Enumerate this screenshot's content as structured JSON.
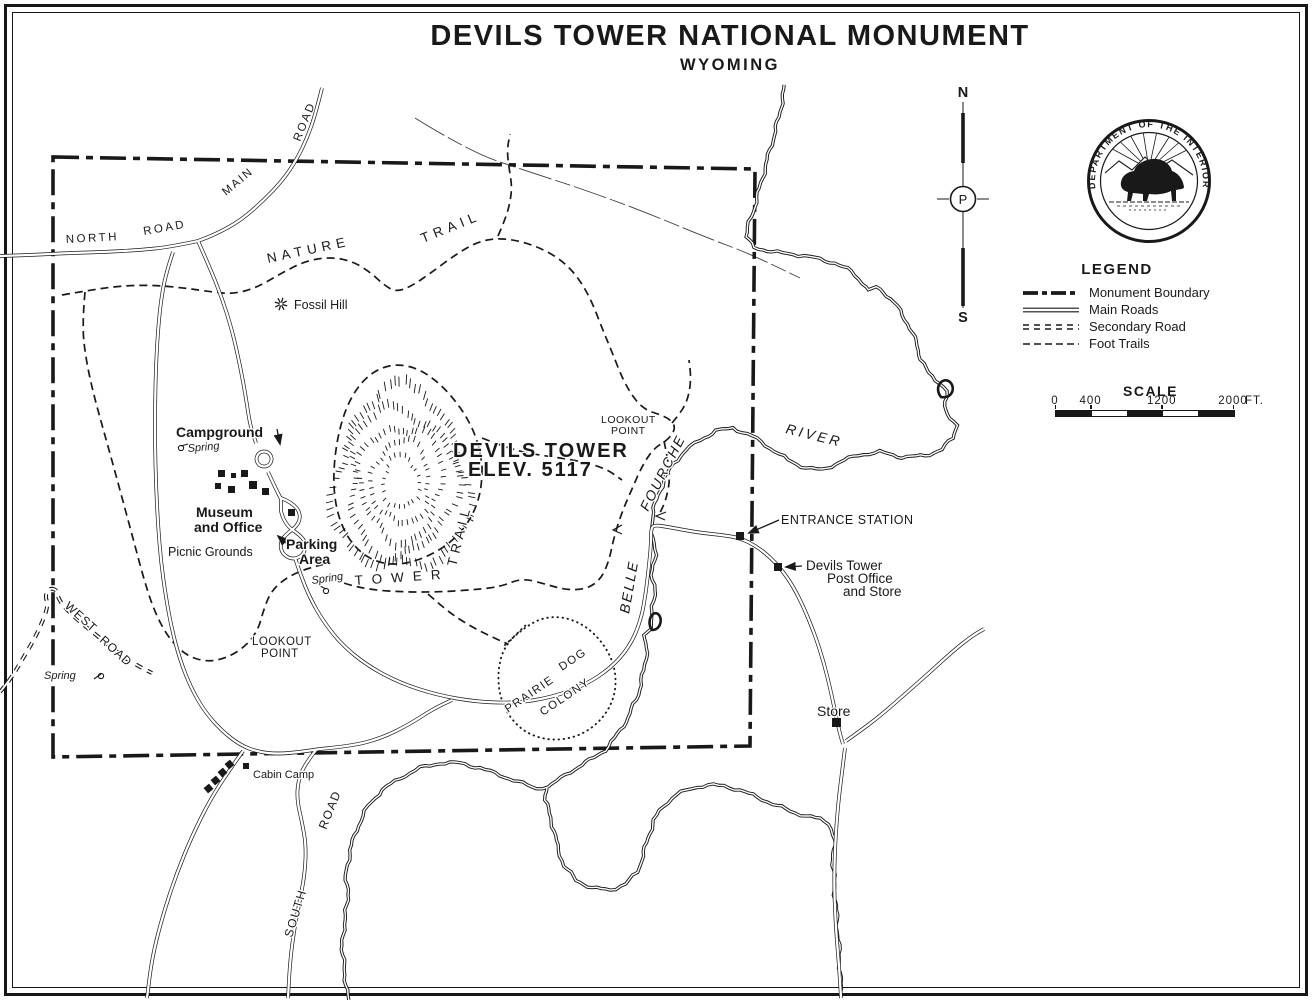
{
  "title": {
    "line1": "DEVILS TOWER NATIONAL MONUMENT",
    "line2": "WYOMING"
  },
  "legend": {
    "heading": "LEGEND",
    "items": [
      {
        "symbol": "monument-boundary-symbol",
        "label": "Monument Boundary"
      },
      {
        "symbol": "main-roads-symbol",
        "label": "Main Roads"
      },
      {
        "symbol": "secondary-road-symbol",
        "label": "Secondary Road"
      },
      {
        "symbol": "foot-trails-symbol",
        "label": "Foot Trails"
      }
    ]
  },
  "scale": {
    "heading": "SCALE",
    "ticks": [
      "0",
      "400",
      "1200",
      "2000"
    ],
    "unit": "FT.",
    "tick_offsets": [
      0,
      35.6,
      106.8,
      178
    ]
  },
  "compass": {
    "north": "N",
    "south": "S",
    "center": "P"
  },
  "seal": {
    "text": "DEPARTMENT OF THE INTERIOR"
  },
  "map": {
    "colors": {
      "ink": "#191919",
      "paper": "#ffffff"
    },
    "labels": [
      {
        "text": "NORTH",
        "x": 66,
        "y": 243,
        "size": 11.5,
        "ls": 2.5,
        "rot": -3
      },
      {
        "text": "ROAD",
        "x": 144,
        "y": 235,
        "size": 11.5,
        "ls": 2.5,
        "rot": -10
      },
      {
        "text": "MAIN",
        "x": 226,
        "y": 196,
        "size": 11.5,
        "ls": 2,
        "rot": -40
      },
      {
        "text": "ROAD",
        "x": 300,
        "y": 142,
        "size": 11.5,
        "ls": 2,
        "rot": -68
      },
      {
        "text": "NATURE",
        "x": 268,
        "y": 263,
        "size": 13.5,
        "ls": 5,
        "rot": -12
      },
      {
        "text": "TRAIL",
        "x": 423,
        "y": 243,
        "size": 13.5,
        "ls": 5,
        "rot": -22
      },
      {
        "text": "Fossil Hill",
        "x": 294,
        "y": 309,
        "size": 12.5
      },
      {
        "text": "Campground",
        "x": 176,
        "y": 437,
        "size": 14,
        "bold": true
      },
      {
        "text": "Spring",
        "x": 188,
        "y": 452,
        "size": 11,
        "italic": true,
        "rot": -5
      },
      {
        "text": "Museum",
        "x": 196,
        "y": 517,
        "size": 14,
        "bold": true
      },
      {
        "text": "and Office",
        "x": 194,
        "y": 532,
        "size": 14,
        "bold": true
      },
      {
        "text": "Picnic Grounds",
        "x": 168,
        "y": 556,
        "size": 12.5
      },
      {
        "text": "Parking",
        "x": 286,
        "y": 549,
        "size": 14,
        "bold": true
      },
      {
        "text": "Area",
        "x": 299,
        "y": 564,
        "size": 14,
        "bold": true
      },
      {
        "text": "Spring",
        "x": 312,
        "y": 584,
        "size": 11,
        "italic": true,
        "rot": -8
      },
      {
        "text": "DEVILS TOWER",
        "x": 453,
        "y": 457,
        "size": 20,
        "ls": 2,
        "bold": true
      },
      {
        "text": "ELEV. 5117",
        "x": 468,
        "y": 476,
        "size": 20,
        "ls": 2,
        "bold": true
      },
      {
        "text": "LOOKOUT",
        "x": 601,
        "y": 423,
        "size": 10.5,
        "ls": 0.5
      },
      {
        "text": "POINT",
        "x": 611,
        "y": 434,
        "size": 10.5,
        "ls": 0.5
      },
      {
        "text": "TOWER",
        "x": 355,
        "y": 585,
        "size": 13.5,
        "ls": 9,
        "rot": -4
      },
      {
        "text": "TRAIL",
        "x": 456,
        "y": 567,
        "size": 13.5,
        "ls": 5,
        "rot": -76
      },
      {
        "text": "LOOKOUT",
        "x": 252,
        "y": 645,
        "size": 11.5,
        "ls": 0.5
      },
      {
        "text": "POINT",
        "x": 261,
        "y": 657,
        "size": 11.5,
        "ls": 0.5
      },
      {
        "text": "Spring",
        "x": 44,
        "y": 679,
        "size": 11,
        "italic": true
      },
      {
        "text": "WEST",
        "x": 64,
        "y": 607,
        "size": 12,
        "ls": 1,
        "rot": 42
      },
      {
        "text": "ROAD",
        "x": 99,
        "y": 641,
        "size": 12,
        "ls": 1,
        "rot": 42
      },
      {
        "text": "ENTRANCE STATION",
        "x": 781,
        "y": 524,
        "size": 12.5,
        "ls": 0.5
      },
      {
        "text": "Devils Tower",
        "x": 806,
        "y": 570,
        "size": 13.5
      },
      {
        "text": "Post Office",
        "x": 827,
        "y": 583,
        "size": 13.5
      },
      {
        "text": "and Store",
        "x": 843,
        "y": 596,
        "size": 13.5
      },
      {
        "text": "Store",
        "x": 817,
        "y": 716,
        "size": 14
      },
      {
        "text": "Cabin Camp",
        "x": 253,
        "y": 778,
        "size": 11
      },
      {
        "text": "SOUTH",
        "x": 292,
        "y": 938,
        "size": 12,
        "ls": 1.5,
        "rot": -73
      },
      {
        "text": "ROAD",
        "x": 326,
        "y": 830,
        "size": 12,
        "ls": 1.5,
        "rot": -68
      },
      {
        "text": "BELLE",
        "x": 629,
        "y": 614,
        "size": 14,
        "ls": 2,
        "rot": -80,
        "italic": true
      },
      {
        "text": "FOURCHE",
        "x": 648,
        "y": 512,
        "size": 14,
        "ls": 2,
        "rot": -63,
        "italic": true
      },
      {
        "text": "RIVER",
        "x": 785,
        "y": 433,
        "size": 14,
        "ls": 3,
        "rot": 14,
        "italic": true
      },
      {
        "text": "PRAIRIE",
        "x": 508,
        "y": 713,
        "size": 11.5,
        "ls": 1.5,
        "rot": -34
      },
      {
        "text": "DOG",
        "x": 562,
        "y": 671,
        "size": 11.5,
        "ls": 1.5,
        "rot": -34
      },
      {
        "text": "COLONY",
        "x": 543,
        "y": 716,
        "size": 11.5,
        "ls": 1.5,
        "rot": -34
      }
    ],
    "markers": {
      "buildings": [
        {
          "name": "campground-building",
          "x": 218,
          "y": 470,
          "s": 7
        },
        {
          "name": "campground-building",
          "x": 231,
          "y": 473,
          "s": 5
        },
        {
          "name": "campground-building",
          "x": 241,
          "y": 470,
          "s": 7
        },
        {
          "name": "campground-building",
          "x": 215,
          "y": 483,
          "s": 6
        },
        {
          "name": "campground-building",
          "x": 228,
          "y": 486,
          "s": 7
        },
        {
          "name": "campground-building",
          "x": 249,
          "y": 481,
          "s": 8
        },
        {
          "name": "campground-building",
          "x": 262,
          "y": 488,
          "s": 7
        },
        {
          "name": "museum-marker",
          "x": 288,
          "y": 509,
          "s": 7
        },
        {
          "name": "entrance-station-marker",
          "x": 736,
          "y": 532,
          "s": 8
        },
        {
          "name": "post-office-marker",
          "x": 774,
          "y": 563,
          "s": 8
        },
        {
          "name": "store-marker",
          "x": 832,
          "y": 718,
          "s": 9
        },
        {
          "name": "cabin-camp-marker",
          "x": 243,
          "y": 763,
          "s": 6
        },
        {
          "name": "cabin-camp-building",
          "x": 226,
          "y": 761,
          "s": 7,
          "rot": -40
        },
        {
          "name": "cabin-camp-building",
          "x": 219,
          "y": 769,
          "s": 7,
          "rot": -40
        },
        {
          "name": "cabin-camp-building",
          "x": 212,
          "y": 777,
          "s": 7,
          "rot": -40
        },
        {
          "name": "cabin-camp-building",
          "x": 205,
          "y": 785,
          "s": 7,
          "rot": -40
        }
      ],
      "springs": [
        {
          "name": "spring-symbol",
          "x": 181,
          "y": 448,
          "tx": 7,
          "ty": -4
        },
        {
          "name": "spring-symbol",
          "x": 326,
          "y": 591,
          "tx": -6,
          "ty": -5
        },
        {
          "name": "spring-symbol",
          "x": 101,
          "y": 676,
          "tx": -7,
          "ty": 3
        }
      ],
      "fossil_hill": {
        "name": "fossil-hill-symbol",
        "x": 281,
        "y": 304
      }
    }
  }
}
